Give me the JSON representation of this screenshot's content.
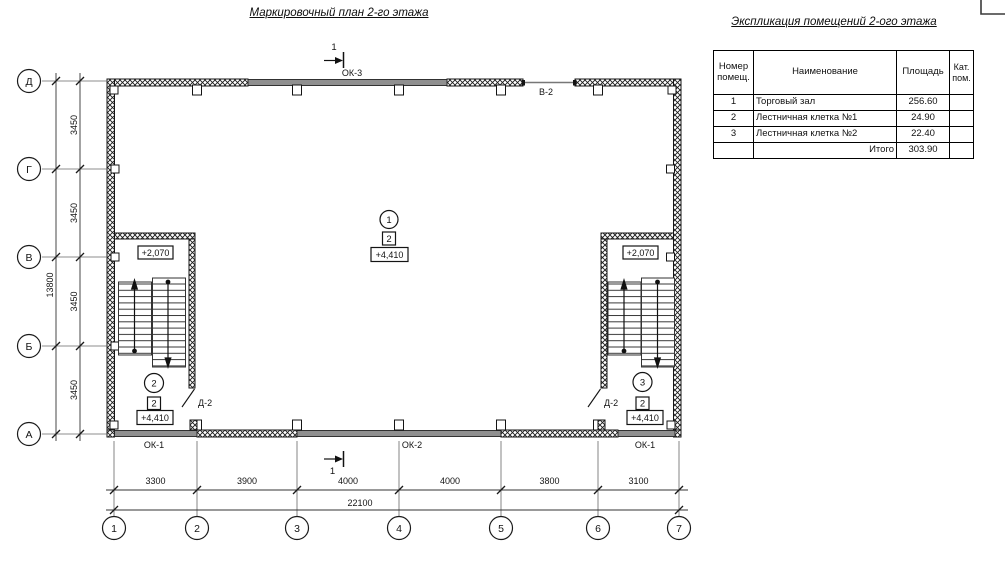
{
  "plan_title": "Маркировочный план 2-го этажа",
  "explication": {
    "title": "Экспликация помещений 2-ого этажа",
    "headers": {
      "number": "Номер помещ.",
      "name": "Наименование",
      "area": "Площадь",
      "category": "Кат. пом."
    },
    "rows": [
      {
        "number": "1",
        "name": "Торговый зал",
        "area": "256.60",
        "category": ""
      },
      {
        "number": "2",
        "name": "Лестничная клетка №1",
        "area": "24.90",
        "category": ""
      },
      {
        "number": "3",
        "name": "Лестничная клетка №2",
        "area": "22.40",
        "category": ""
      }
    ],
    "total_label": "Итого",
    "total_area": "303.90"
  },
  "axes": {
    "columns": [
      "1",
      "2",
      "3",
      "4",
      "5",
      "6",
      "7"
    ],
    "rows": [
      "Д",
      "Г",
      "В",
      "Б",
      "А"
    ]
  },
  "dimensions": {
    "bottom": [
      "3300",
      "3900",
      "4000",
      "4000",
      "3800",
      "3100"
    ],
    "bottom_total": "22100",
    "left": [
      "3450",
      "3450",
      "3450",
      "3450"
    ],
    "left_total": "13800"
  },
  "labels": {
    "window_ok1": "ОК-1",
    "window_ok2": "ОК-2",
    "window_ok3": "ОК-3",
    "opening_v2": "В-2",
    "door_d2": "Д-2",
    "section_mark": "1",
    "level_landing": "+2,070",
    "level_main": "+4,410"
  },
  "rooms": {
    "hall": {
      "num": "1",
      "cat": "2"
    },
    "stair1": {
      "num": "2",
      "cat": "2"
    },
    "stair2": {
      "num": "3",
      "cat": "2"
    }
  },
  "colors": {
    "line": "#141414",
    "window_fill": "#8f8f8f",
    "thin": "#666666"
  }
}
